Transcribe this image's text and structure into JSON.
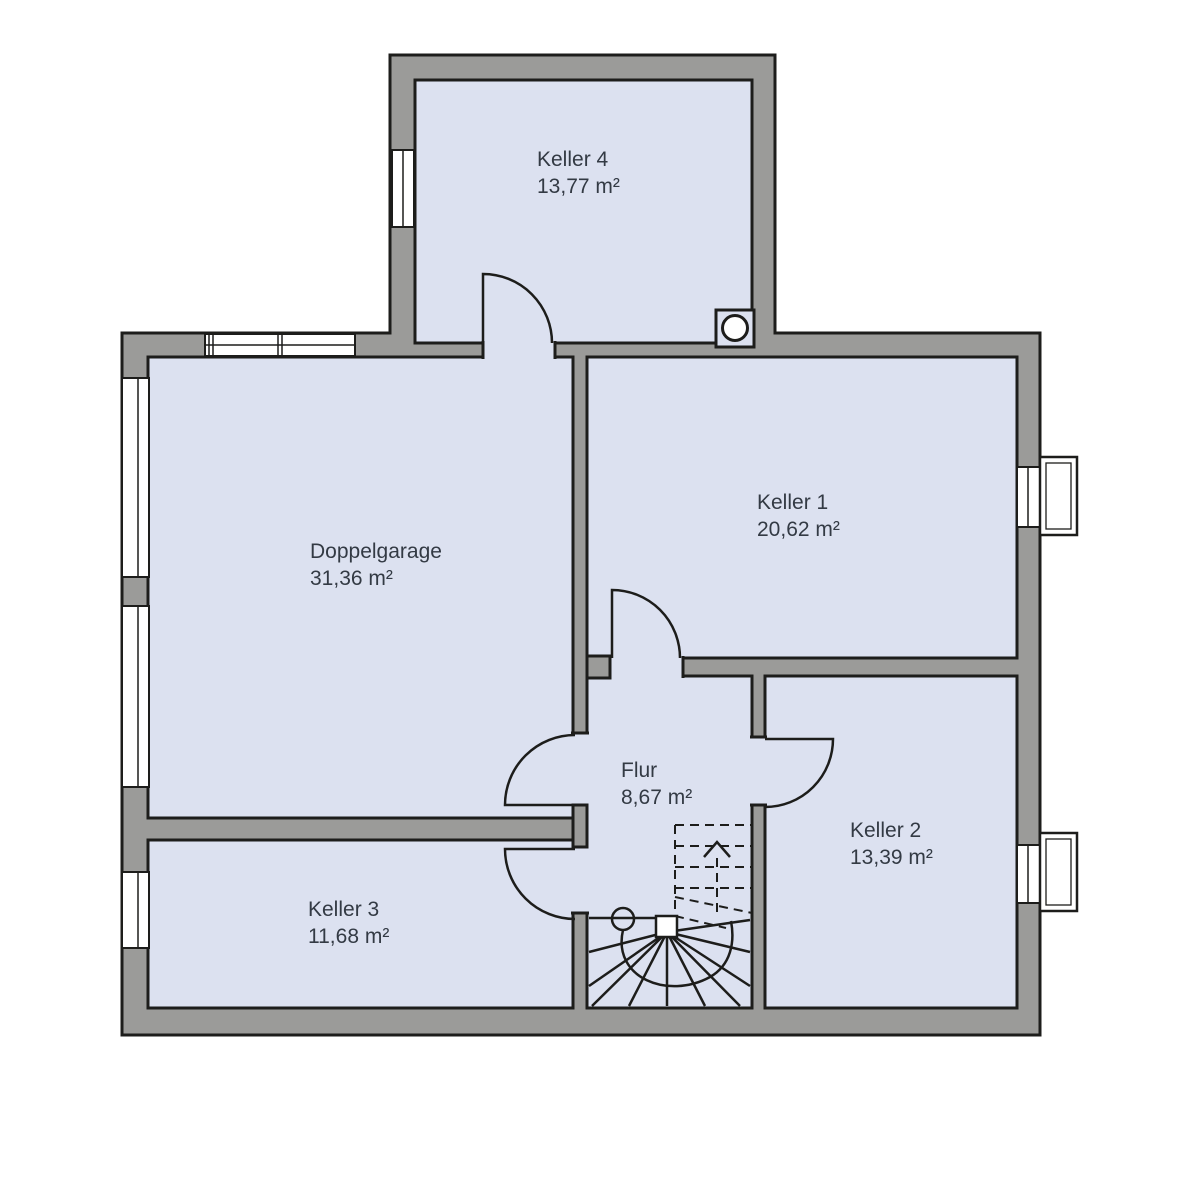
{
  "rooms": {
    "keller4": {
      "name": "Keller 4",
      "area": "13,77 m²"
    },
    "doppelgarage": {
      "name": "Doppelgarage",
      "area": "31,36 m²"
    },
    "keller1": {
      "name": "Keller 1",
      "area": "20,62 m²"
    },
    "flur": {
      "name": "Flur",
      "area": "8,67 m²"
    },
    "keller2": {
      "name": "Keller 2",
      "area": "13,39 m²"
    },
    "keller3": {
      "name": "Keller 3",
      "area": "11,68 m²"
    }
  },
  "colors": {
    "wall": "#9b9b99",
    "line": "#1d1d1b",
    "room_fill": "#dce1f0",
    "text": "#333a44",
    "background": "#ffffff",
    "window_fill": "#ffffff"
  }
}
